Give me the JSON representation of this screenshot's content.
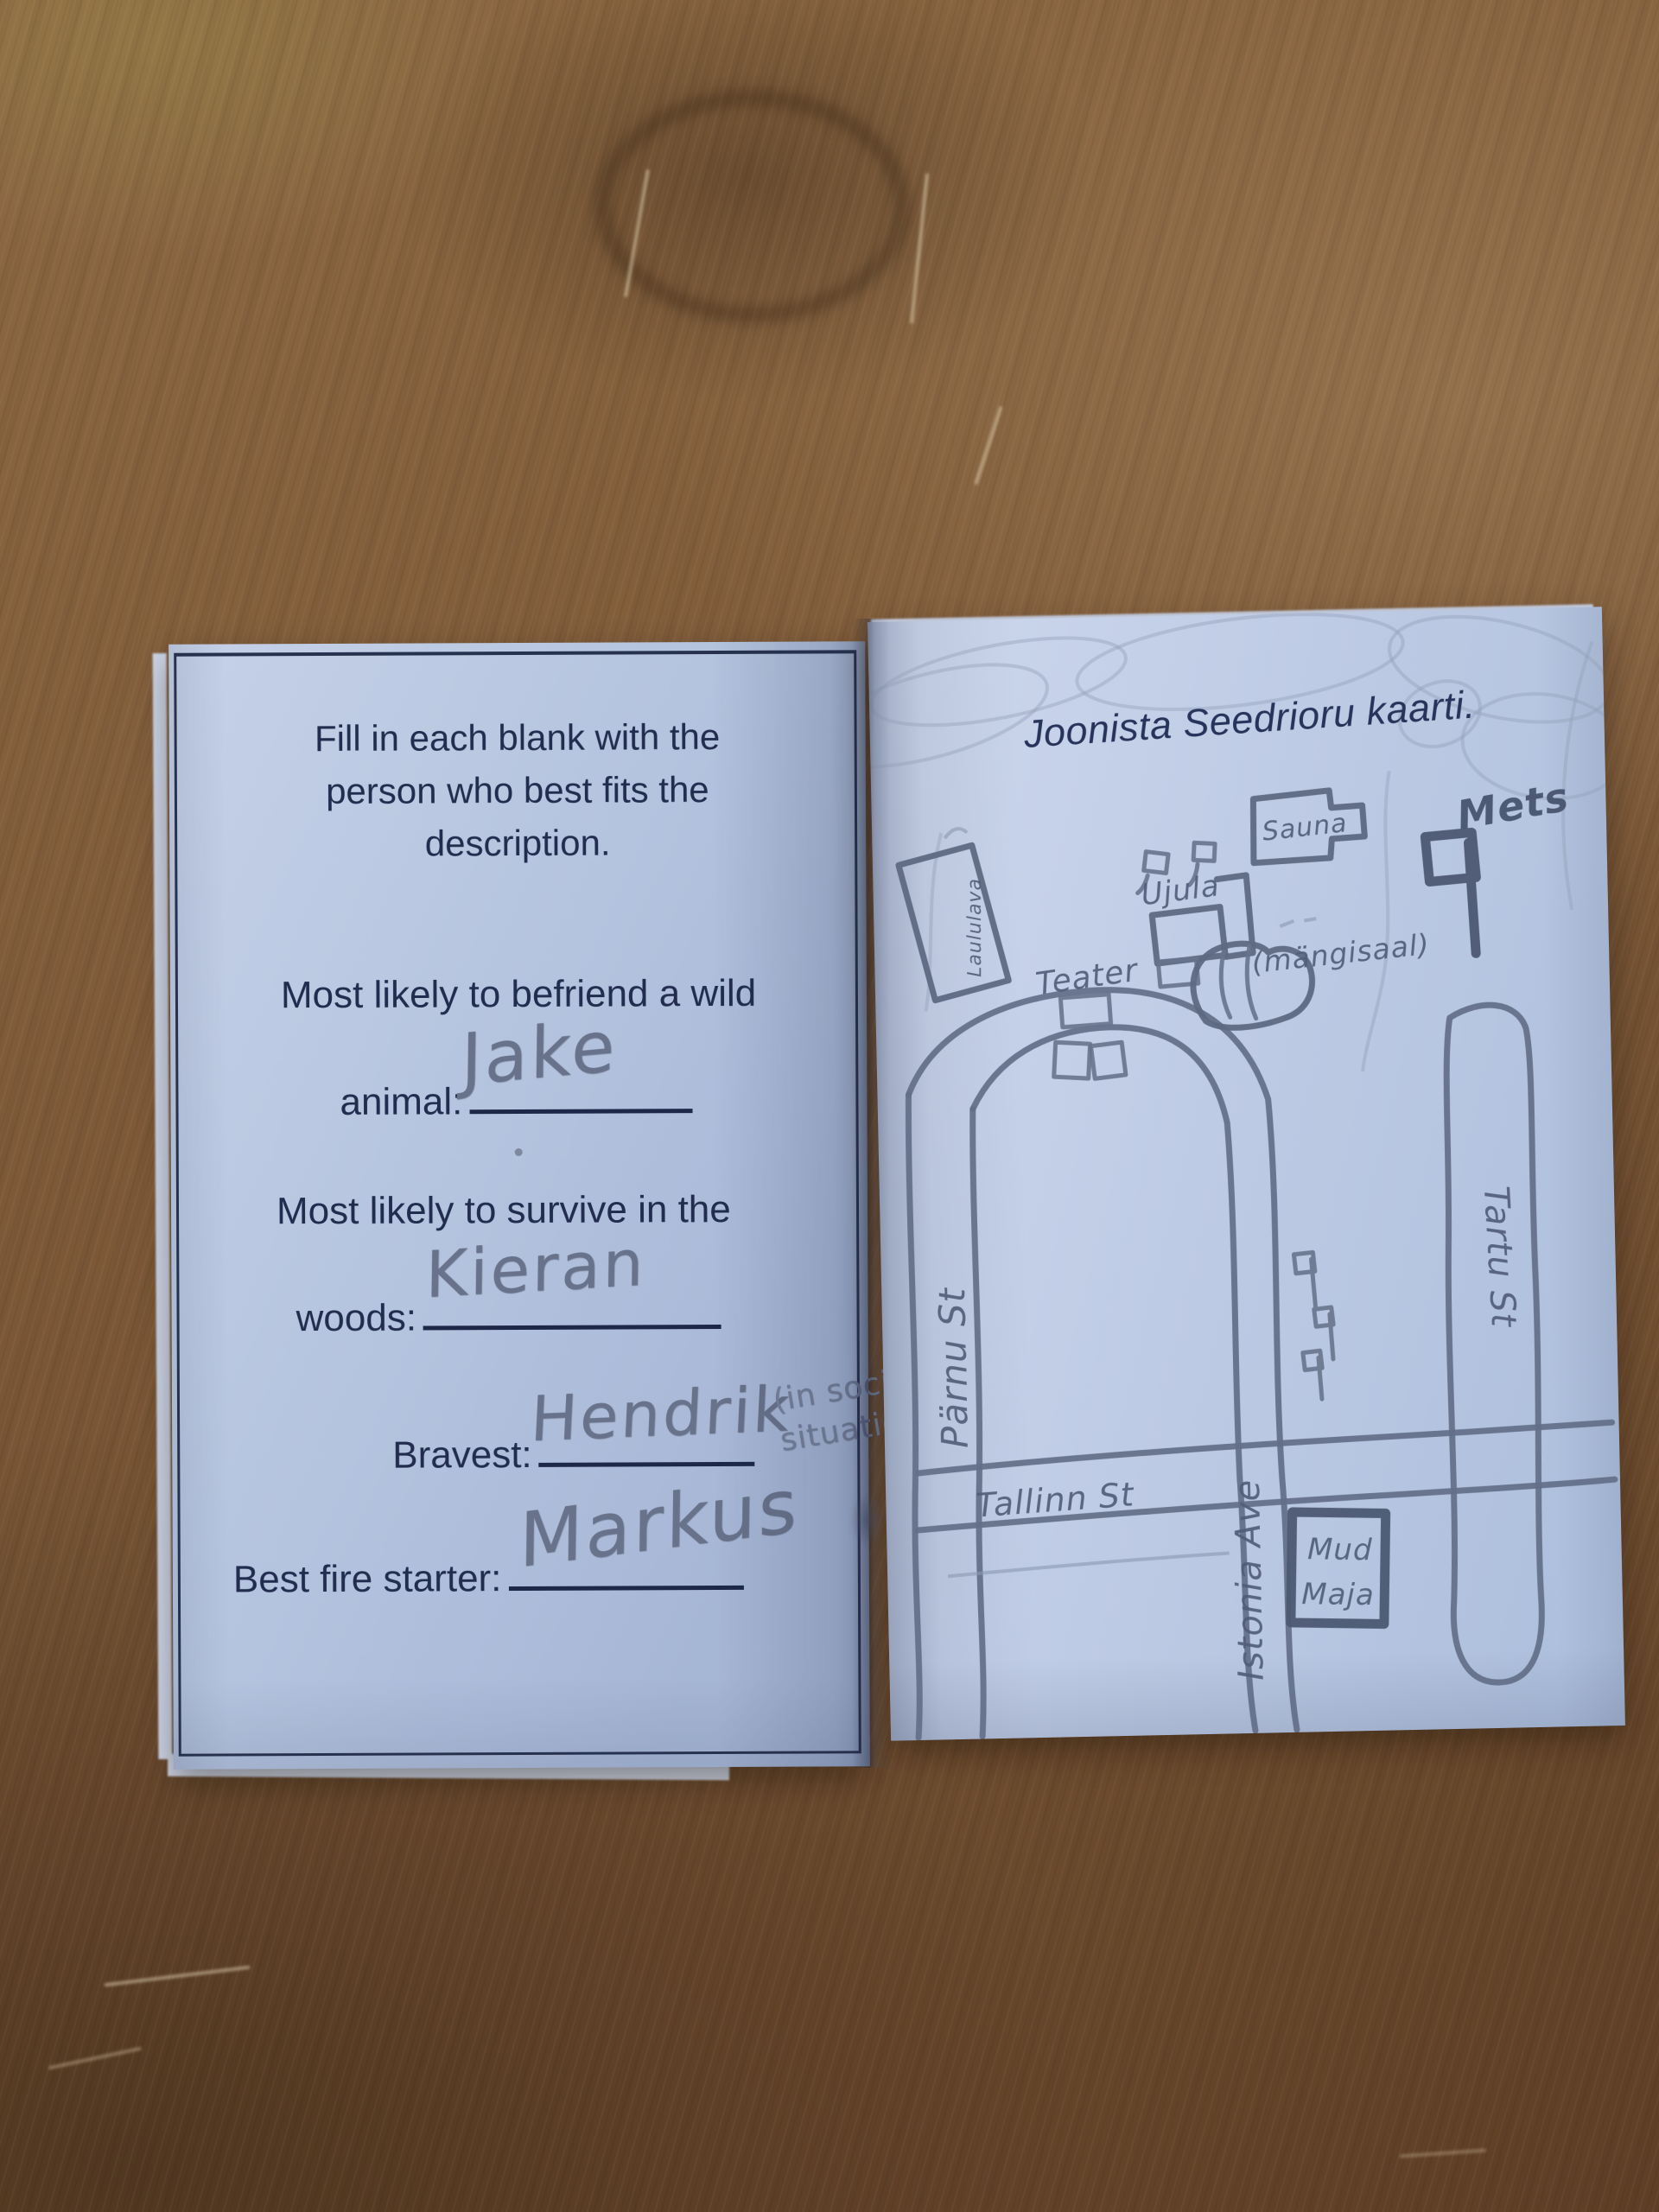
{
  "colors": {
    "paper": "#bcc9e2",
    "printed_ink": "#212c4e",
    "pencil": "#5d6982",
    "wood_table": "#7d5938"
  },
  "left_page": {
    "instructions": "Fill in each blank with the person who best fits the description.",
    "q1": {
      "line1": "Most likely to befriend a wild",
      "label": "animal:",
      "answer": "Jake"
    },
    "q2": {
      "line1": "Most likely to survive in the",
      "label": "woods:",
      "answer": "Kieran"
    },
    "q3": {
      "label": "Bravest:",
      "answer": "Hendrik",
      "note_line1": "(in social",
      "note_line2": "situations)"
    },
    "q4": {
      "label": "Best fire starter:",
      "answer": "Markus"
    }
  },
  "right_page": {
    "title": "Joonista Seedrioru kaarti.",
    "map_labels": {
      "laululava": "Laululava",
      "sauna": "Sauna",
      "ujula": "Ujula",
      "teater": "Teater",
      "mangisaal": "(mängisaal)",
      "mets": "Mets",
      "parnu": "Pärnu St",
      "tallinn": "Tallinn St",
      "istonia": "Istonia Ave",
      "tartu": "Tartu St",
      "mudmaja_line1": "Mud",
      "mudmaja_line2": "Maja"
    }
  }
}
